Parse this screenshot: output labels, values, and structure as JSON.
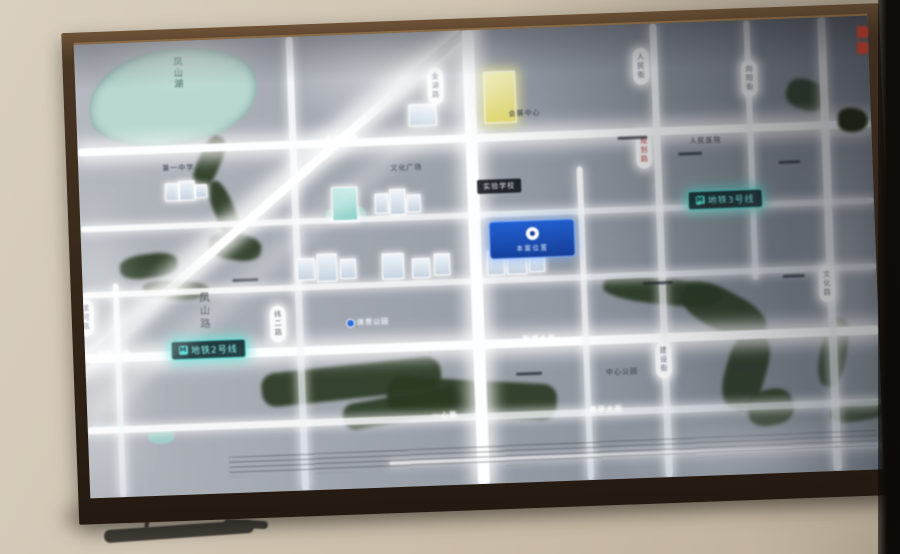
{
  "colors": {
    "wall": "#cfc3b1",
    "frame_wood": "#4a3625",
    "panel_base": "#969ca5",
    "road_glow": "#fdfeff",
    "water_dark": "#2c3a24",
    "lake_teal": "#b9d8d2",
    "metro_teal": "#56dcd2",
    "project_blue": "#2160d2",
    "red_mark": "#b23a2c"
  },
  "map": {
    "lake_label": "凤山湖",
    "road_vertical_label": "凤山路",
    "road_pills": [
      "金湖路",
      "人民街",
      "向阳街",
      "规划路",
      "纬二路",
      "建设街",
      "滨河路",
      "文化路"
    ],
    "metro_icon_glyph": "M",
    "metro_lines": [
      "地铁2号线",
      "地铁3号线"
    ],
    "project_sign": "本案位置",
    "road_names": [
      "金湖西路",
      "滨湖大路",
      "新城大街",
      "一心路",
      "南环大街"
    ],
    "poi": [
      "文化广场",
      "会展中心",
      "实验学校",
      "体育公园",
      "人民医院",
      "中心公园",
      "商业中心",
      "第一中学"
    ]
  }
}
